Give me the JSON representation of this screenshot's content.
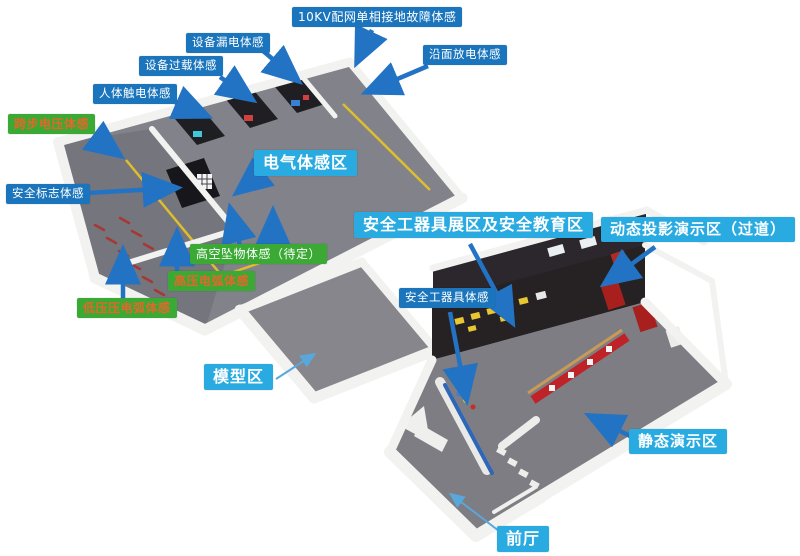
{
  "labels": {
    "ten_kv": {
      "text": "10KV配网单相接地故障体感",
      "style": "blue"
    },
    "equip_leak": {
      "text": "设备漏电体感",
      "style": "blue"
    },
    "equip_overload": {
      "text": "设备过载体感",
      "style": "blue"
    },
    "body_shock": {
      "text": "人体触电体感",
      "style": "blue"
    },
    "surface_discharge": {
      "text": "沿面放电体感",
      "style": "blue"
    },
    "step_voltage": {
      "text": "跨步电压体感",
      "style": "green-orange"
    },
    "safety_sign": {
      "text": "安全标志体感",
      "style": "blue"
    },
    "electric_zone": {
      "text": "电气体感区",
      "style": "cyan"
    },
    "falling_objects": {
      "text": "高空坠物体感（待定）",
      "style": "green-white"
    },
    "hv_arc": {
      "text": "高压电弧体感",
      "style": "green-orange"
    },
    "lv_arc": {
      "text": "低压压电弧体感",
      "style": "green-orange"
    },
    "tool_exhibit_zone": {
      "text": "安全工器具展区及安全教育区",
      "style": "cyan"
    },
    "dynamic_projection": {
      "text": "动态投影演示区（过道）",
      "style": "cyan"
    },
    "safety_tools": {
      "text": "安全工器具体感",
      "style": "blue"
    },
    "model_zone": {
      "text": "模型区",
      "style": "cyan"
    },
    "static_demo_zone": {
      "text": "静态演示区",
      "style": "cyan"
    },
    "front_hall": {
      "text": "前厅",
      "style": "cyan"
    }
  },
  "colors": {
    "label_blue": "#1b75bc",
    "label_cyan": "#29abe2",
    "label_green": "#3aaa35",
    "green_label_text_orange": "#e2672a",
    "arrow_blue": "#2373c4",
    "floor_gray": "#808086",
    "wall_white": "#f2f2f0",
    "booth_black": "#1f1f23",
    "exhibit_red": "#bf2328",
    "marking_yellow": "#ddbe2e"
  }
}
